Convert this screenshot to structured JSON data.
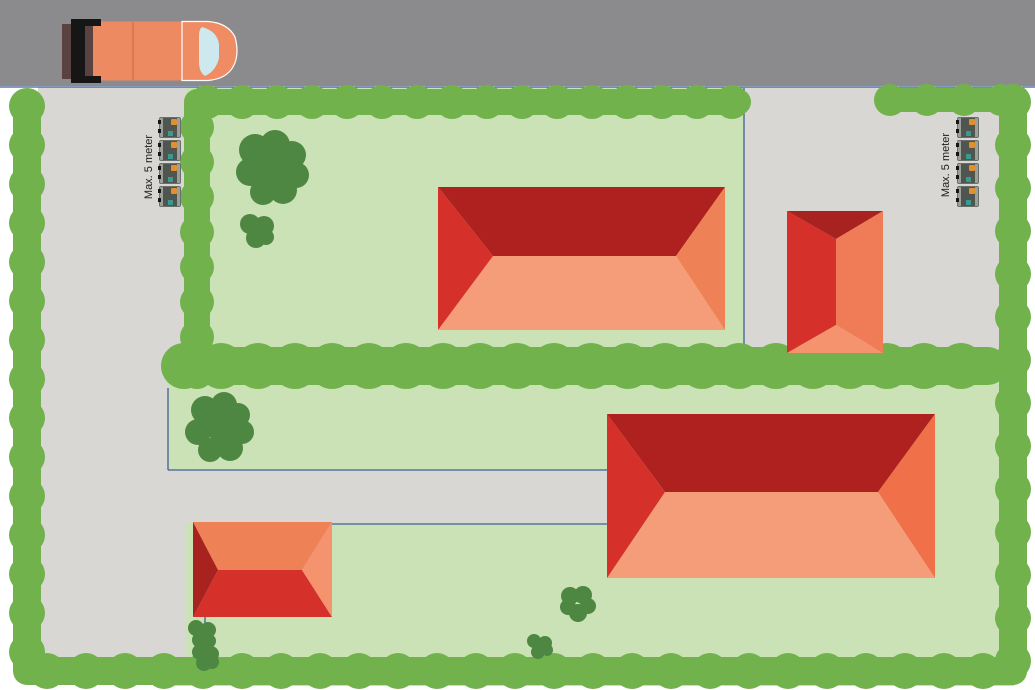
{
  "labels": {
    "left_max_distance": "Max. 5 meter",
    "right_max_distance": "Max. 5 meter"
  },
  "meter_boxes": {
    "left_count": 4,
    "right_count": 4
  },
  "colors": {
    "road": "#8b8a8d",
    "pavement": "#d9d7d4",
    "lawn": "#cbe2b7",
    "hedge": "#72b24c",
    "tree": "#4d8741",
    "boundary_line": "#3f5f94",
    "white_gap": "#ffffff",
    "truck_body": "#ee8a62",
    "truck_cab": "#ef8c63",
    "truck_rear": "#5a4241",
    "truck_bumper": "#161616",
    "truck_windshield": "#cde9ef",
    "truck_seam": "#d87a52",
    "meter_frame": "#9ba09b",
    "meter_body": "#50564f",
    "meter_orange": "#e0912d",
    "meter_teal": "#3a9a8f"
  },
  "houses": {
    "top_left": {
      "top": "#ae211f",
      "bottom": "#f59d79",
      "left": "#d6302b",
      "right": "#ef8157"
    },
    "right_small": {
      "top": "#a82220",
      "bottom": "#f5936f",
      "left": "#d6302b",
      "right": "#ef7c57"
    },
    "bottom_right": {
      "top": "#ae211f",
      "bottom": "#f59d79",
      "left": "#d6302b",
      "right": "#ef7049"
    },
    "bottom_left": {
      "top": "#ef8157",
      "bottom": "#d6302b",
      "left": "#a82220",
      "right": "#f5936f"
    }
  }
}
